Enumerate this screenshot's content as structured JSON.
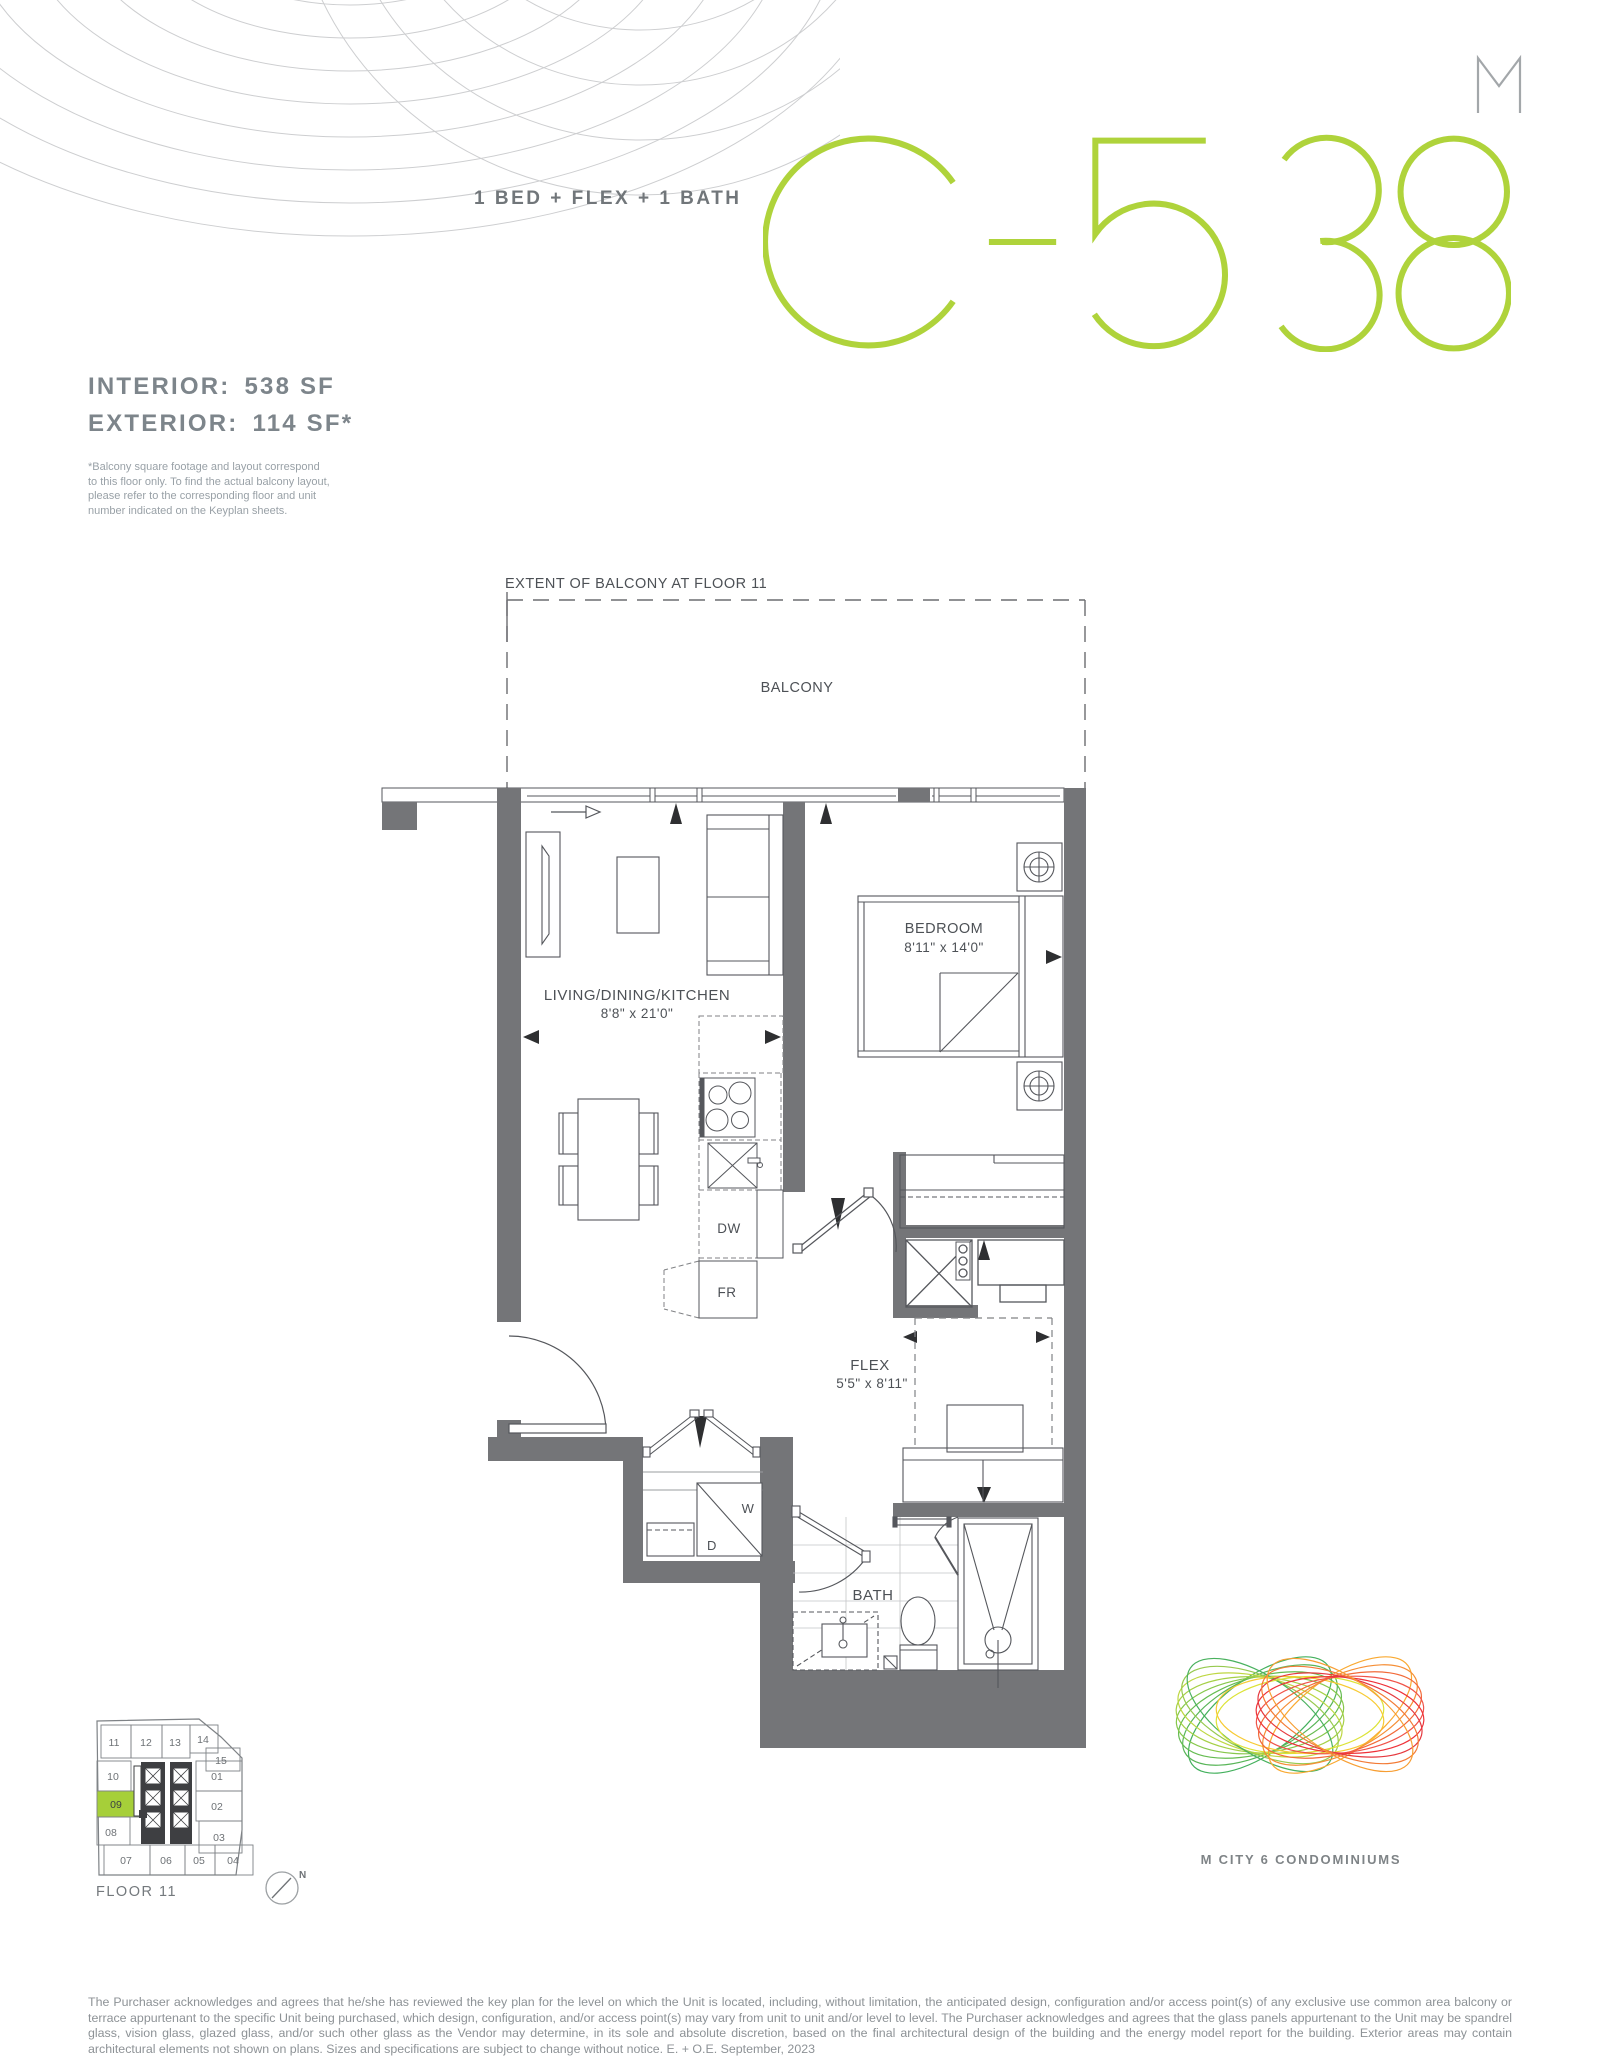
{
  "header": {
    "plan_type": "1 BED + FLEX + 1 BATH",
    "unit_code": "C-538",
    "interior_label": "INTERIOR:",
    "interior_value": "538 SF",
    "exterior_label": "EXTERIOR:",
    "exterior_value": "114 SF*",
    "balcony_note": "*Balcony square footage and layout correspond to this floor only. To find the actual balcony layout, please refer to the corresponding floor and unit number indicated on the Keyplan sheets."
  },
  "colors": {
    "accent_green": "#AFD33B",
    "wall_gray": "#747578",
    "heading_gray": "#7D858B"
  },
  "floor_plan": {
    "extent_label": "EXTENT OF BALCONY AT FLOOR 11",
    "balcony_label": "BALCONY",
    "rooms": {
      "living": {
        "name": "LIVING/DINING/KITCHEN",
        "dims": "8'8\" x 21'0\""
      },
      "bedroom": {
        "name": "BEDROOM",
        "dims": "8'11\" x 14'0\""
      },
      "flex": {
        "name": "FLEX",
        "dims": "5'5\" x 8'11\""
      },
      "bath": {
        "name": "BATH"
      }
    },
    "appliances": {
      "dishwasher": "DW",
      "fridge": "FR",
      "washer": "W",
      "dryer": "D"
    }
  },
  "keyplan": {
    "floor_label": "FLOOR 11",
    "highlighted_unit": "09",
    "units": [
      "11",
      "12",
      "13",
      "14",
      "15",
      "10",
      "01",
      "09",
      "02",
      "08",
      "03",
      "07",
      "06",
      "05",
      "04"
    ],
    "north_label": "N"
  },
  "branding": {
    "logo_letter": "M",
    "name": "M CITY 6 CONDOMINIUMS"
  },
  "footer": {
    "disclaimer": "The Purchaser acknowledges and agrees that he/she has reviewed the key plan for the level on which the Unit is located, including, without limitation, the anticipated design, configuration and/or access point(s) of any exclusive use common area balcony or terrace appurtenant to the specific Unit being purchased, which design, configuration, and/or access point(s) may vary from unit to unit and/or level to level. The Purchaser acknowledges and agrees that the glass panels appurtenant to the Unit may be spandrel glass, vision glass, glazed glass, and/or such other glass as the Vendor may determine, in its sole and absolute discretion, based on the final architectural design of the building and the energy model report for the building. Exterior areas may contain architectural elements not shown on plans. Sizes and specifications are subject to change without notice. E. + O.E. September, 2023"
  }
}
